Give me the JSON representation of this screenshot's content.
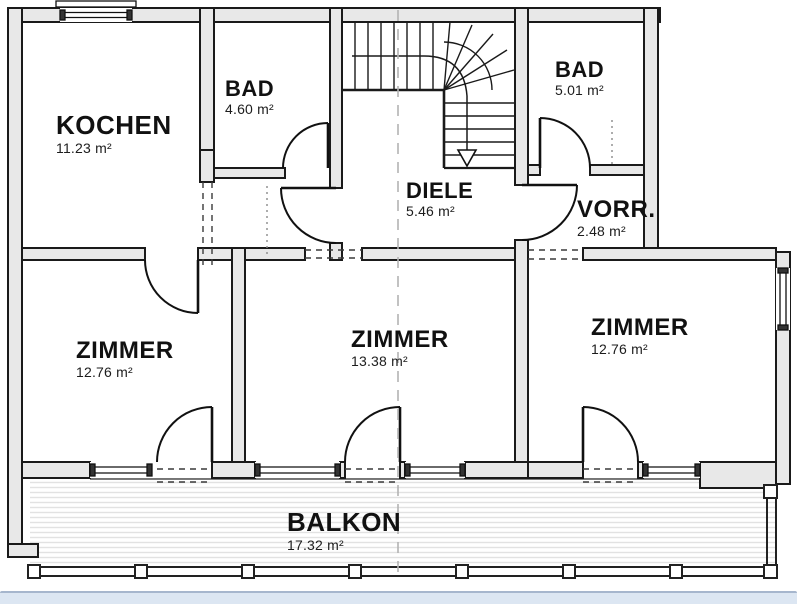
{
  "drawing_type": "apartment floor plan",
  "rooms": [
    {
      "id": "kochen",
      "name": "KOCHEN",
      "area": "11.23 m²"
    },
    {
      "id": "bad-left",
      "name": "BAD",
      "area": "4.60 m²"
    },
    {
      "id": "bad-right",
      "name": "BAD",
      "area": "5.01 m²"
    },
    {
      "id": "diele",
      "name": "DIELE",
      "area": "5.46 m²"
    },
    {
      "id": "vorraum",
      "name": "VORR.",
      "area": "2.48 m²"
    },
    {
      "id": "zimmer-left",
      "name": "ZIMMER",
      "area": "12.76 m²"
    },
    {
      "id": "zimmer-mid",
      "name": "ZIMMER",
      "area": "13.38 m²"
    },
    {
      "id": "zimmer-right",
      "name": "ZIMMER",
      "area": "12.76 m²"
    },
    {
      "id": "balkon",
      "name": "BALKON",
      "area": "17.32 m²"
    }
  ],
  "colors": {
    "wall_fill": "#e8e8e8",
    "line": "#1a1a1a",
    "section_line": "#b3b3b3",
    "balcony_stripe": "#e2e2e2",
    "bottom_bar": "#dce6f2"
  }
}
